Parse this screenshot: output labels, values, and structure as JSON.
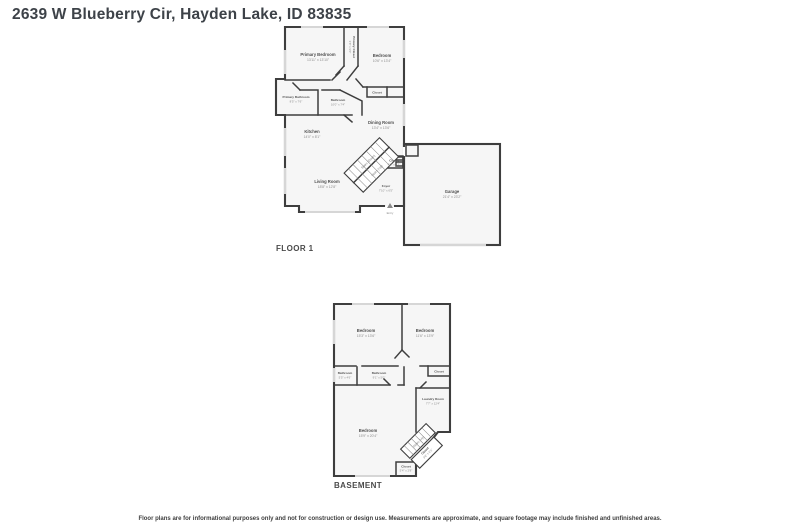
{
  "title": "2639 W Blueberry Cir, Hayden Lake, ID 83835",
  "disclaimer": "Floor plans are for informational purposes only and not for construction or design use. Measurements are approximate, and square footage may include finished and unfinished areas.",
  "colors": {
    "wall": "#3e3e3e",
    "floor": "#f6f6f6",
    "window": "#d6d6d6",
    "label": "#4f4f4f",
    "dims": "#8d8d8d"
  },
  "floor1": {
    "label": "FLOOR 1",
    "rooms": {
      "primary_bedroom": {
        "name": "Primary Bedroom",
        "dims": "13'11\" x 13'10\""
      },
      "primary_closet": {
        "name": "Primary Closet",
        "dims": "3'8\" x 9'0\""
      },
      "bedroom": {
        "name": "Bedroom",
        "dims": "10'6\" x 13'4\""
      },
      "primary_bathroom": {
        "name": "Primary Bathroom",
        "dims": "8'5\" x 7'6\""
      },
      "bathroom": {
        "name": "Bathroom",
        "dims": "10'0\" x 7'4\""
      },
      "bedroom_closet": {
        "name": "Closet"
      },
      "dining_room": {
        "name": "Dining Room",
        "dims": "13'4\" x 13'6\""
      },
      "kitchen": {
        "name": "Kitchen",
        "dims": "14'0\" x 8'1\""
      },
      "living_room": {
        "name": "Living Room",
        "dims": "18'8\" x 12'8\""
      },
      "foyer": {
        "name": "Foyer",
        "dims": "7'10\" x 6'5\""
      },
      "stair_closet": {
        "name": "Closet",
        "dims": "4'0\" x 2'3\""
      },
      "garage": {
        "name": "Garage",
        "dims": "21'4\" x 23'2\""
      },
      "stairs_down": {
        "name": "Stairs (Down)"
      },
      "stairs_up": {
        "name": "Stairs (Up)"
      },
      "entry": {
        "name": "Entry"
      }
    }
  },
  "basement": {
    "label": "BASEMENT",
    "rooms": {
      "bedroom_left": {
        "name": "Bedroom",
        "dims": "15'3\" x 13'6\""
      },
      "bedroom_right": {
        "name": "Bedroom",
        "dims": "11'6\" x 13'9\""
      },
      "bathroom_small": {
        "name": "Bathroom",
        "dims": "5'5\" x 4'6\""
      },
      "bathroom": {
        "name": "Bathroom",
        "dims": "9'1\" x 5'0\""
      },
      "closet_right": {
        "name": "Closet"
      },
      "laundry_room": {
        "name": "Laundry Room",
        "dims": "7'7\" x 12'4\""
      },
      "bedroom_lower": {
        "name": "Bedroom",
        "dims": "15'9\" x 20'4\""
      },
      "stairs_up": {
        "name": "Stairs (Up)"
      },
      "stair_closet": {
        "name": "Closet",
        "dims": "3'8\" x 6'1\""
      },
      "closet_bottom": {
        "name": "Closet",
        "dims": "5'4\" x 2'8\""
      }
    }
  }
}
